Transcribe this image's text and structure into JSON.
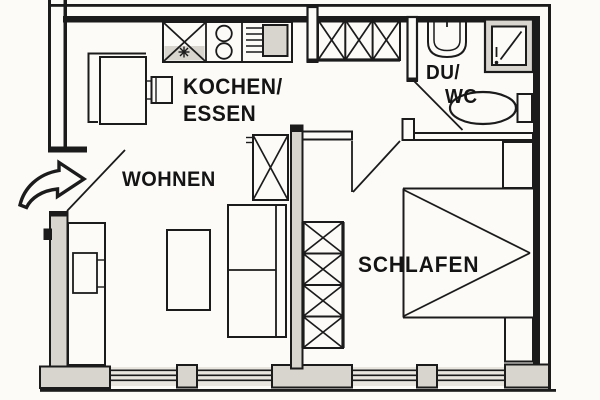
{
  "title": "Apartment floor plan (scanned architectural drawing)",
  "colors": {
    "paper": "#fcfbf8",
    "line": "#1b1b1b",
    "wall_fill": "#d8d5cf",
    "window_fill": "#e9e6e0"
  },
  "rooms": [
    {
      "name": "kitchen-dining",
      "label_line1": "KOCHEN/",
      "label_line2": "ESSEN"
    },
    {
      "name": "living",
      "label": "WOHNEN"
    },
    {
      "name": "shower-wc",
      "label_line1": "DU/",
      "label_line2": "WC"
    },
    {
      "name": "bedroom",
      "label": "SCHLAFEN"
    }
  ],
  "entrance": {
    "icon": "curved-arrow",
    "meaning": "apartment entrance at left wall"
  },
  "fixtures": {
    "kitchen": [
      "sink",
      "cooktop-two-burners",
      "kitchen-appliance",
      "dining-table",
      "corner-bench",
      "chair"
    ],
    "hall": [
      "wardrobe-three-sections"
    ],
    "living": [
      "shelf",
      "sofa",
      "coffee-table",
      "sideboard"
    ],
    "bathroom": [
      "washbasin",
      "shower",
      "toilet"
    ],
    "bedroom": [
      "wardrobe-four-sections",
      "bed",
      "nightstand-top",
      "nightstand-bottom"
    ]
  }
}
